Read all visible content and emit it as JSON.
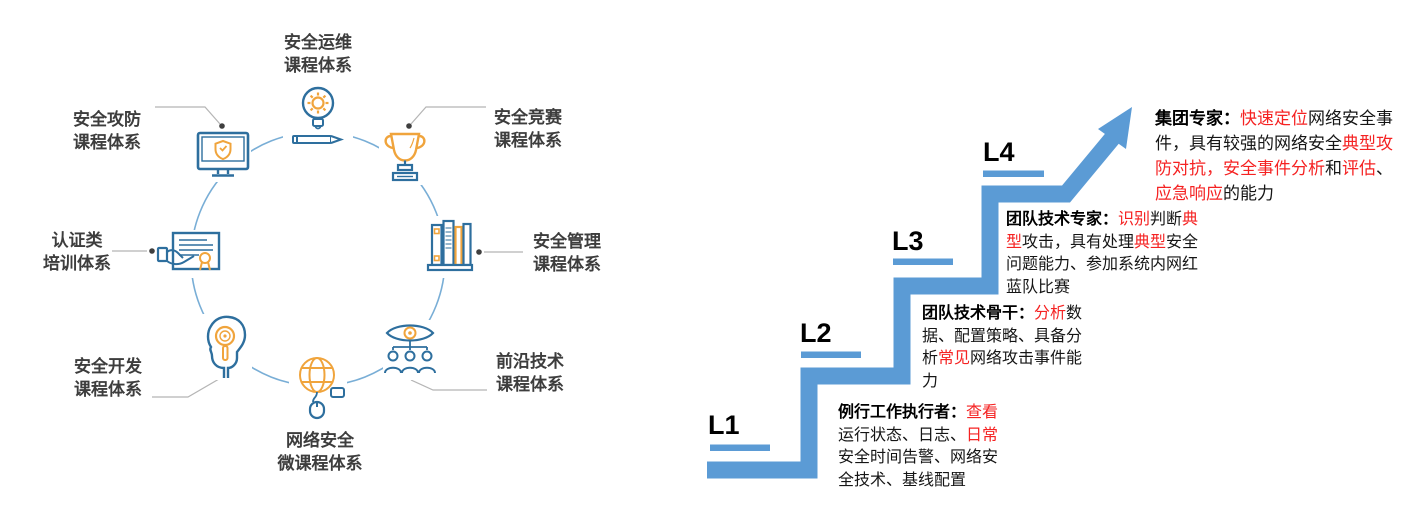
{
  "canvas": {
    "width": 1404,
    "height": 524,
    "background": "#ffffff"
  },
  "colors": {
    "icon_blue": "#2e6f9e",
    "icon_orange": "#f0a43c",
    "wheel_circle_blue": "#79aed6",
    "stair_blue": "#5b9bd5",
    "highlight_red": "#f52222",
    "label_gray": "#3d3d3d",
    "connector_gray": "#b5b5b5",
    "dot_gray": "#3f3f3f",
    "text_black": "#151515"
  },
  "course_wheel": {
    "items": [
      {
        "id": "sec-ops",
        "icon": "bulb-gear-icon",
        "label_lines": [
          "安全运维",
          "课程体系"
        ]
      },
      {
        "id": "sec-attack-defense",
        "icon": "monitor-shield-icon",
        "label_lines": [
          "安全攻防",
          "课程体系"
        ]
      },
      {
        "id": "sec-competition",
        "icon": "trophy-icon",
        "label_lines": [
          "安全竞赛",
          "课程体系"
        ]
      },
      {
        "id": "cert-training",
        "icon": "certificate-icon",
        "label_lines": [
          "认证类",
          "培训体系"
        ]
      },
      {
        "id": "sec-management",
        "icon": "books-icon",
        "label_lines": [
          "安全管理",
          "课程体系"
        ]
      },
      {
        "id": "sec-dev",
        "icon": "head-key-icon",
        "label_lines": [
          "安全开发",
          "课程体系"
        ]
      },
      {
        "id": "frontier-tech",
        "icon": "eye-people-icon",
        "label_lines": [
          "前沿技术",
          "课程体系"
        ]
      },
      {
        "id": "network-micro",
        "icon": "globe-mouse-icon",
        "label_lines": [
          "网络安全",
          "微课程体系"
        ]
      }
    ]
  },
  "ladder": {
    "levels": [
      {
        "label": "L1",
        "role": "例行工作执行者：",
        "segments": [
          {
            "t": "查看",
            "red": true
          },
          {
            "t": "运行状态、日志、"
          },
          {
            "t": "日常",
            "red": true
          },
          {
            "t": "安全时间告警、网络安全技术、基线配置"
          }
        ]
      },
      {
        "label": "L2",
        "role": "团队技术骨干：",
        "segments": [
          {
            "t": "分析",
            "red": true
          },
          {
            "t": "数据、配置策略、具备分析"
          },
          {
            "t": "常见",
            "red": true
          },
          {
            "t": "网络攻击事件能力"
          }
        ]
      },
      {
        "label": "L3",
        "role": "团队技术专家：",
        "segments": [
          {
            "t": "识别",
            "red": true
          },
          {
            "t": "判断"
          },
          {
            "t": "典型",
            "red": true
          },
          {
            "t": "攻击，具有处理"
          },
          {
            "t": "典型",
            "red": true
          },
          {
            "t": "安全问题能力、参加系统内网红蓝队比赛"
          }
        ]
      },
      {
        "label": "L4",
        "role": "集团专家：",
        "segments": [
          {
            "t": "快速定位",
            "red": true
          },
          {
            "t": "网络安全事件，具有较强的网络安全"
          },
          {
            "t": "典型攻防对抗，安全事件分析",
            "red": true
          },
          {
            "t": "和"
          },
          {
            "t": "评估",
            "red": true
          },
          {
            "t": "、"
          },
          {
            "t": "应急响应",
            "red": true
          },
          {
            "t": "的能力"
          }
        ]
      }
    ]
  }
}
